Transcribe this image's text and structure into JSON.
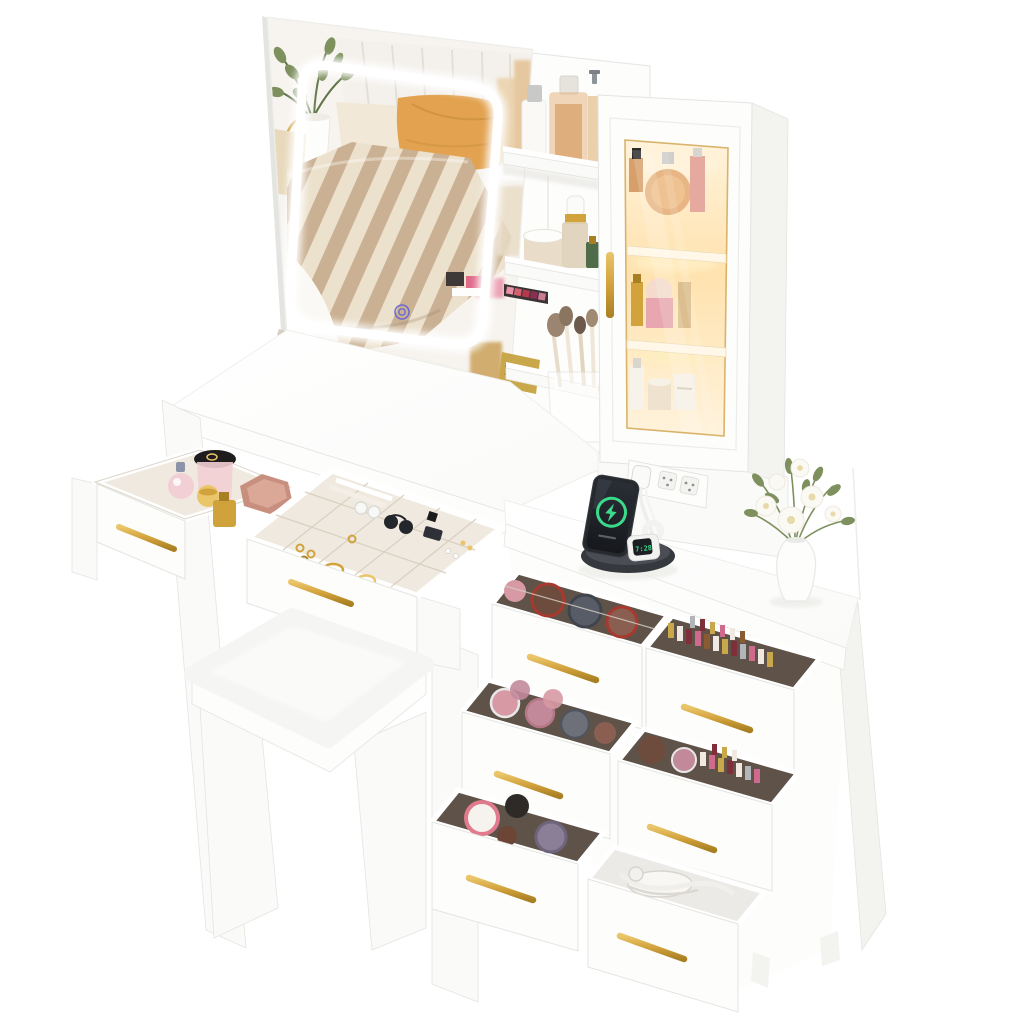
{
  "scene": {
    "type": "product-photo",
    "subject": "White vanity dressing table set: LED square mirror reflecting a bedroom, open storage shelves, glass-door display cabinet with warm interior lighting, built-in power strip, wireless charging dock with phone and smartwatch, two pull-out jewelry/perfume drawers, six-drawer cascading side chest full of cosmetics, white vase with flowers, and a cushioned vanity stool",
    "background": "#ffffff"
  },
  "objects": {
    "mirror": {
      "style": "square LED touch mirror",
      "reflection": "bed with striped duvet, orange pillow, tufted headboard, green plant",
      "touch_button": "concentric blue rings"
    },
    "open_shelves": {
      "count": 3,
      "items": [
        "white pump bottle",
        "amber square perfume",
        "cream jar",
        "gold dropper bottle",
        "green bottle",
        "eyeshadow palettes",
        "clear cup of makeup brushes"
      ]
    },
    "display_cabinet": {
      "door": "glass with gold trim",
      "handle": "gold bar",
      "lit": true,
      "shelf_items": [
        "amber round perfume",
        "pink bottles",
        "pink jar",
        "gold sprays",
        "cream jars"
      ]
    },
    "power_strip": {
      "outlets": 3,
      "plug_inserted": true
    },
    "charging_dock": {
      "base": "black oval",
      "phone": {
        "status_icon": "green charging ring with lightning bolt"
      },
      "watch": {
        "display": "7:28"
      }
    },
    "desk_drawers": [
      {
        "name": "perfume drawer",
        "contents": [
          "pink perfume",
          "black-lid jar",
          "gold jar",
          "gold bottle",
          "rose-gold mirror"
        ]
      },
      {
        "name": "jewelry drawer",
        "contents": [
          "sunglasses",
          "rings",
          "watch",
          "bracelets",
          "earrings"
        ]
      }
    ],
    "side_chest": {
      "drawer_count": 6,
      "contents": [
        "powder compacts",
        "lipsticks",
        "blush compacts",
        "cream jars",
        "white appliance with cable"
      ],
      "handles": "gold bars"
    },
    "stool": {
      "style": "white cushioned stool with panel legs"
    },
    "vase": {
      "color": "white",
      "flowers": "white blossoms with greenery"
    }
  },
  "palette": {
    "white": "#ffffff",
    "paper": "#fdfdfc",
    "face": "#fafaf8",
    "side": "#f3f3f0",
    "under": "#ededea",
    "edge": "#e4e4e1",
    "line": "#d9d9d5",
    "tan_edge": "#cfc5b6",
    "gold": "#d2a23c",
    "gold_light": "#eac56a",
    "gold_dark": "#a87f22",
    "touch": "#5a5ed8",
    "warm_hi": "#fff3dc",
    "warm_mid": "#ffe2ae",
    "warm_deep": "#f6c77c",
    "amber": "#e8b584",
    "amber_deep": "#d7a06a",
    "wall": "#f7f4ef",
    "headboard": "#f4f1ec",
    "seam": "#e4dfd6",
    "pillow_orange": "#e2a24f",
    "pillow_fold": "#c98f3f",
    "pillow_cream": "#f1e8d8",
    "pillow_beige": "#e8d9bd",
    "stripe_a": "#cbb193",
    "stripe_b": "#ece1cd",
    "sheet": "#fbf9f5",
    "floor_tan": "#d9cfc0",
    "plant": "#7d905e",
    "plant_dark": "#5f7547",
    "dock": "#35383d",
    "dock_top": "#4a4e54",
    "phone_body": "#26292e",
    "phone_screen": "#16181c",
    "green": "#3ad98c",
    "watch_body": "#f2f2f0",
    "socket": "#8e939a",
    "velvet": "#efe9df",
    "velvet_line": "#d9d0c0",
    "int_dark": "#5f5349",
    "comp_brown": "#6e4c3d",
    "comp_red": "#a8392f",
    "comp_slate": "#575c66",
    "comp_pink": "#d79aa4",
    "comp_rose": "#c2899b",
    "comp_gray": "#6e7079",
    "comp_tan": "#8a5f52",
    "jar_pink_rim": "#e07a8c",
    "jar_black": "#2e2a28",
    "jar_purple": "#8a7f96",
    "jar_brown": "#6b4636",
    "lip1": "#c9a84c",
    "lip2": "#efe9e2",
    "lip3": "#7e2f3a",
    "lip4": "#d06a8c",
    "lip5": "#8a5a30",
    "lip6": "#b2b6ba",
    "blush": "#f2cfd4",
    "rosegold": "#c98f7e",
    "rosegold_light": "#dba898",
    "perfume_gold": "#cfa23c",
    "green_glass": "#4e6b4a"
  }
}
